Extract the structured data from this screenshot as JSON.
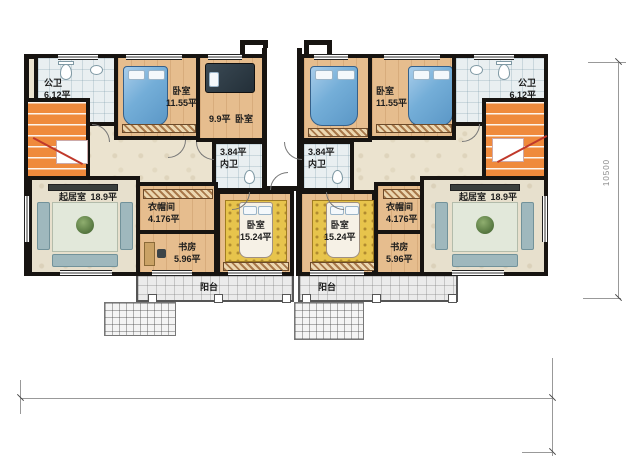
{
  "plan": {
    "left": {
      "public_bath": {
        "name": "公卫",
        "area": "6.12平"
      },
      "bedroom_top": {
        "name": "卧室",
        "area": "11.55平"
      },
      "bedroom_small": {
        "area": "9.9平",
        "name": "卧室"
      },
      "inner_bath": {
        "area": "3.84平",
        "name": "内卫"
      },
      "living": {
        "name": "起居室",
        "area": "18.9平"
      },
      "cloak": {
        "name": "衣帽间",
        "area": "4.176平"
      },
      "study": {
        "name": "书房",
        "area": "5.96平"
      },
      "bedroom_mid": {
        "name": "卧室",
        "area": "15.24平"
      },
      "balcony": {
        "name": "阳台"
      }
    },
    "right": {
      "public_bath": {
        "name": "公卫",
        "area": "6.12平"
      },
      "bedroom_top": {
        "name": "卧室",
        "area": "11.55平"
      },
      "inner_bath": {
        "area": "3.84平",
        "name": "内卫"
      },
      "living": {
        "name": "起居室",
        "area": "18.9平"
      },
      "cloak": {
        "name": "衣帽间",
        "area": "4.176平"
      },
      "study": {
        "name": "书房",
        "area": "5.96平"
      },
      "bedroom_mid": {
        "name": "卧室",
        "area": "15.24平"
      },
      "balcony": {
        "name": "阳台"
      }
    },
    "dimensions": {
      "height_mm": "10500"
    }
  }
}
